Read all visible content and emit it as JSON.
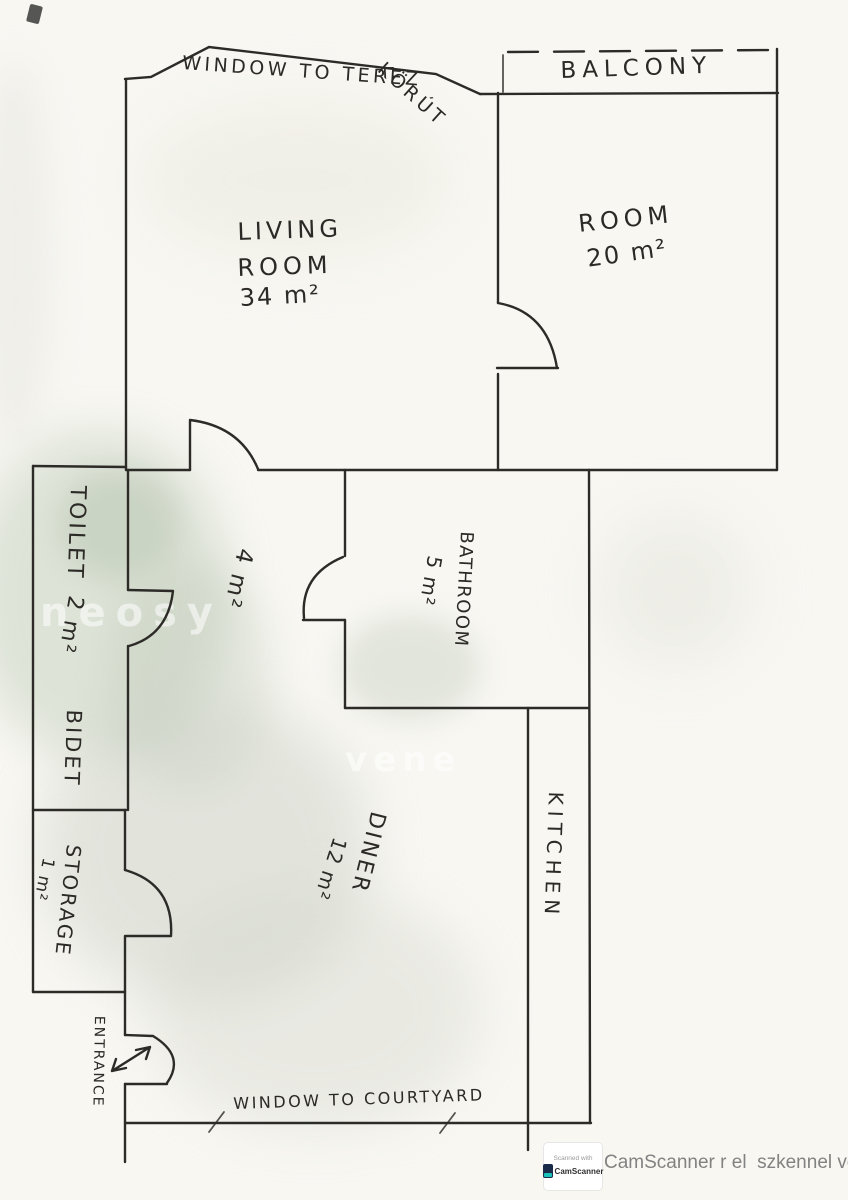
{
  "labels": {
    "window_street_1": "WINDOW TO TEREZ",
    "window_street_2": "KÖRÚT",
    "balcony": "BALCONY",
    "living_1": "LIVING",
    "living_2": "ROOM",
    "living_area": "34 m²",
    "room": "ROOM",
    "room_area": "20 m²",
    "toilet": "TOILET",
    "toilet_area": "2 m²",
    "bidet": "BIDET",
    "hall_area": "4 m²",
    "bathroom": "BATHROOM",
    "bathroom_area": "5 m²",
    "kitchen": "KITCHEN",
    "diner": "DINER",
    "diner_area": "12 m²",
    "storage": "STORAGE",
    "storage_area": "1 m²",
    "entrance": "ENTRANCE",
    "window_courtyard": "WINDOW TO COURTYARD"
  },
  "watermarks": {
    "w1": "neosy",
    "w2": "vene"
  },
  "footer": {
    "badge_line1": "Scanned with",
    "badge_line2": "CamScanner",
    "caption": "CamScanner r el  szkennel ve"
  },
  "colors": {
    "ink": "#2d2b27",
    "paper": "#f8f7f2",
    "stain_green": "#b6c2b0",
    "badge_teal": "#19c2b8",
    "footer_text": "#828282"
  }
}
